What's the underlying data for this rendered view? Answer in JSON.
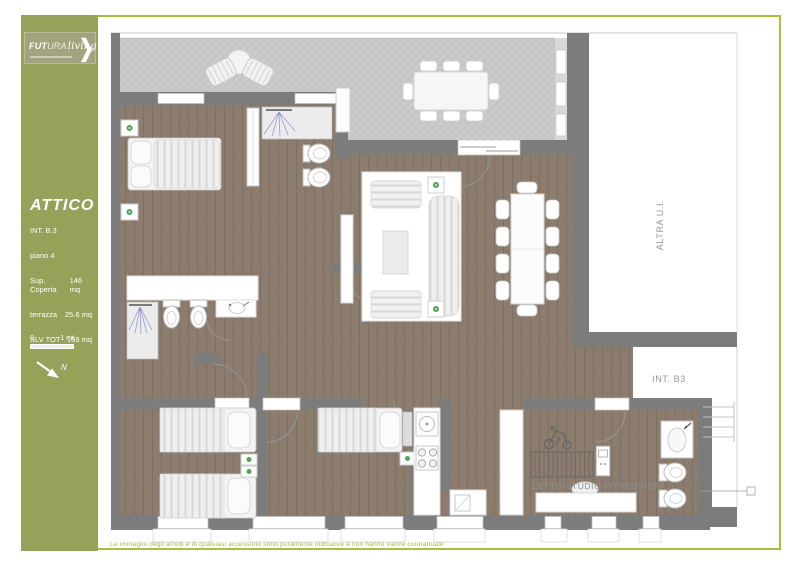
{
  "page": {
    "bg": "#ffffff",
    "frame_color": "#a8c13c"
  },
  "sidebar": {
    "bg": "#96a15a",
    "logo": {
      "brand_bold": "FUT",
      "brand_light": "URA",
      "script": "living",
      "chevron": "❯"
    },
    "title": "ATTICO",
    "info": [
      {
        "label": "INT. B.3",
        "value": ""
      },
      {
        "label": "piano 4",
        "value": ""
      },
      {
        "label": "Sup. Coperta",
        "value": "146 mq"
      },
      {
        "label": "terrazza",
        "value": "25.6 mq"
      },
      {
        "label": "SLV TOT",
        "value": "159 mq"
      }
    ],
    "scale": {
      "zero": "0",
      "one": "1 mt",
      "north": "N"
    }
  },
  "plan": {
    "labels": {
      "altra_ui": "ALTRA U.I.",
      "int_b3": "INT. B3",
      "fitness": "LETTO/STUDIO/FITNESS/SPA"
    },
    "colors": {
      "wall": "#7c7c7c",
      "wood": "#8b7c6e",
      "tile": "#cbcbcb",
      "terrace_wall_light": "#d8d8d8",
      "accent_dot": "#3f9b45",
      "shower_blue": "#8f8fd0"
    }
  },
  "footer": {
    "disclaimer": "Le immagini degli arredi e di qualsiasi accessorio sono puramente indicative e non hanno valore contrattuale"
  }
}
